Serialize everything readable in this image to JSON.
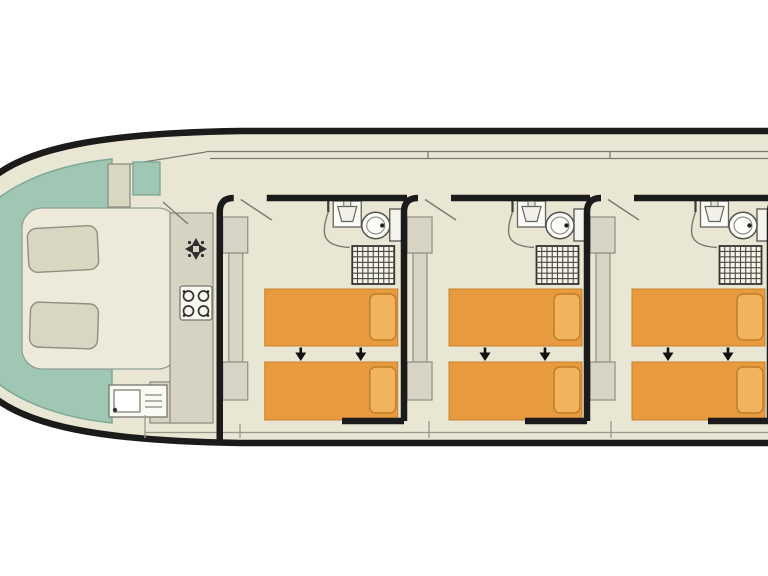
{
  "diagram": {
    "type": "houseboat-deck-plan-top-view",
    "text_labels": [],
    "colors": {
      "background": "#ffffff",
      "hull_outline": "#1b1b1b",
      "deck_cream": "#e9e6d4",
      "floor_cream": "#edeada",
      "bow_deck_teal": "#9fc7b4",
      "teal_border": "#7da795",
      "furniture_beige": "#d8d5c5",
      "furniture_border": "#8f8f82",
      "counter_gray": "#d6d3c3",
      "bed_orange": "#e79b3e",
      "bed_border": "#c9812c",
      "pillow_orange": "#f1b35d",
      "pillow_border": "#c07f28",
      "fixture_white": "#fbfbf7",
      "fixture_line": "#555550",
      "thin_line": "#9a9a8c",
      "wall_black": "#1b1b1b"
    },
    "bow_lounge": {
      "bench_seats": 2,
      "helm_console": 1,
      "deck_step": 1
    },
    "galley": {
      "fixtures": [
        "fan-vent",
        "four-burner-stove",
        "sink-with-drainer"
      ]
    },
    "cabins": [
      {
        "id": "cabin-1",
        "beds": 2,
        "pillows": 2,
        "bed_slide_arrows": 2,
        "wardrobes": 3,
        "bathroom_fixtures": [
          "washbasin",
          "toilet",
          "shower"
        ]
      },
      {
        "id": "cabin-2",
        "beds": 2,
        "pillows": 2,
        "bed_slide_arrows": 2,
        "wardrobes": 3,
        "bathroom_fixtures": [
          "washbasin",
          "toilet",
          "shower"
        ]
      },
      {
        "id": "cabin-3",
        "beds": 2,
        "pillows": 2,
        "bed_slide_arrows": 2,
        "wardrobes": 3,
        "bathroom_fixtures": [
          "washbasin",
          "toilet",
          "shower"
        ]
      }
    ]
  }
}
